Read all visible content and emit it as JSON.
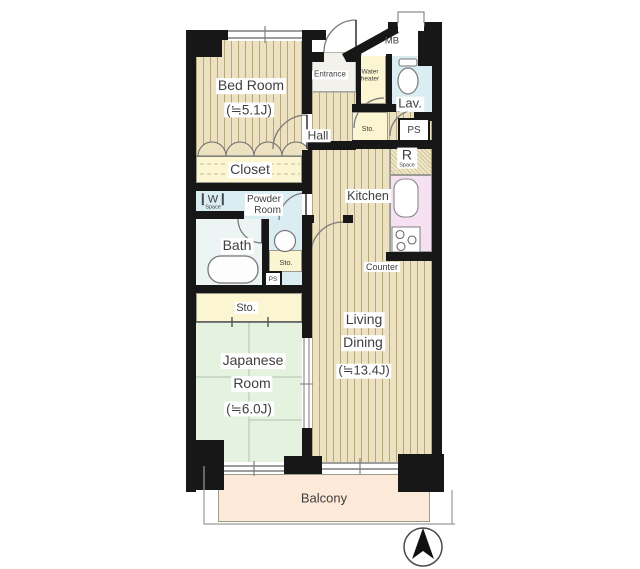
{
  "plan": {
    "type": "apartment-floor-plan",
    "rooms": {
      "bed_room": {
        "name": "Bed Room",
        "size": "(≒5.1J)"
      },
      "closet": {
        "name": "Closet"
      },
      "washer_space": {
        "symbol": "W",
        "label": "Space"
      },
      "powder_room": {
        "line1": "Powder",
        "line2": "Room"
      },
      "bath": {
        "name": "Bath"
      },
      "storage_mid": {
        "name": "Sto."
      },
      "pipe_shaft_mid": {
        "name": "PS"
      },
      "storage_big": {
        "name": "Sto."
      },
      "japanese_room": {
        "line1": "Japanese",
        "line2": "Room",
        "size": "(≒6.0J)"
      },
      "entrance": {
        "name": "Entrance"
      },
      "hall": {
        "name": "Hall"
      },
      "water_heater": {
        "line1": "Water",
        "line2": "heater"
      },
      "meter_box": {
        "name": "MB"
      },
      "lavatory": {
        "name": "Lav."
      },
      "storage_tiny": {
        "name": "Sto."
      },
      "pipe_shaft": {
        "name": "PS"
      },
      "fridge_space": {
        "symbol": "R",
        "label": "Space"
      },
      "kitchen": {
        "name": "Kitchen"
      },
      "counter": {
        "name": "Counter"
      },
      "living_dining": {
        "line1": "Living",
        "line2": "Dining",
        "size": "(≒13.4J)"
      },
      "balcony": {
        "name": "Balcony"
      }
    },
    "icons": {
      "north_arrow": "compass-needle-in-circle",
      "bathtub": "rounded-rect",
      "toilet": "ellipse-bowl",
      "sink_round": "circle",
      "kitchen_sink": "rounded-rect",
      "stove": "three-burner-circles"
    },
    "colors": {
      "wall": "#171717",
      "wood_floor": "#ece2c1",
      "wood_line": "#b5a67c",
      "tatami": "#e5f2e0",
      "water_blue": "#d9edf3",
      "cream": "#fbf5d2",
      "counter_pink": "#f6e1f2",
      "balcony_peach": "#fce9d8"
    }
  }
}
